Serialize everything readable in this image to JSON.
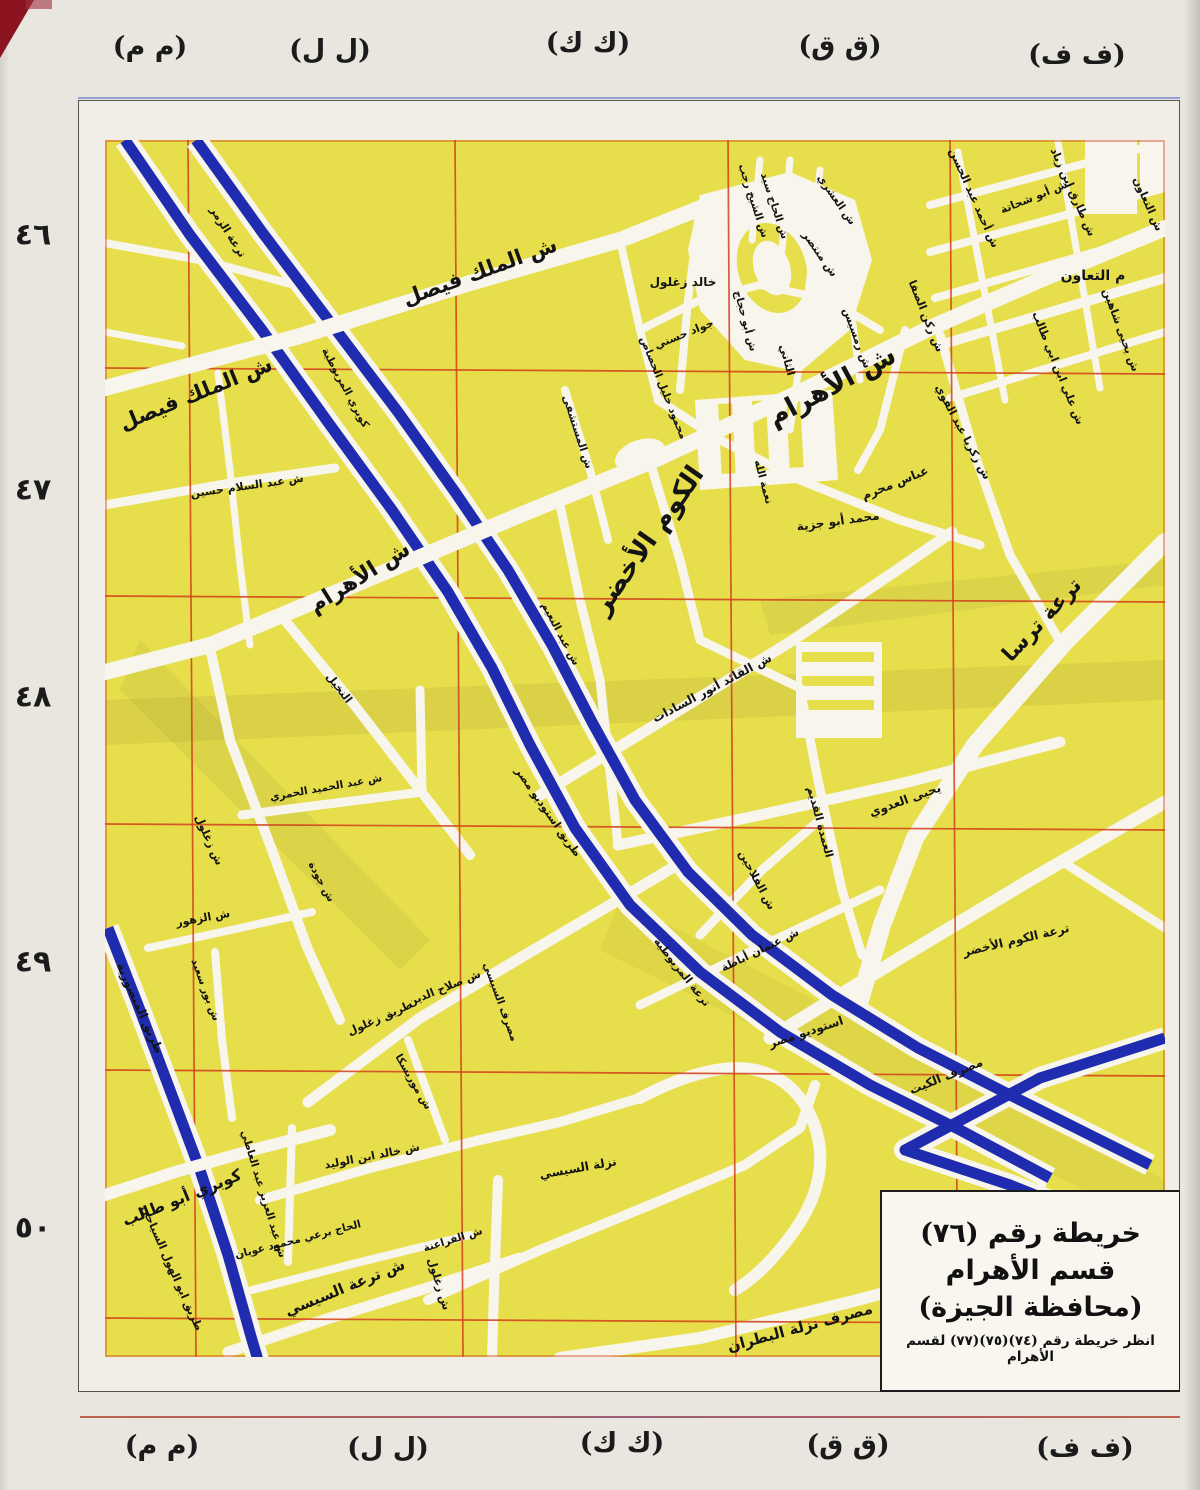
{
  "map_meta": {
    "title_line1": "خريطة رقم (٧٦)",
    "title_line2": "قسم الأهرام",
    "title_line3": "(محافظة الجيزة)",
    "title_line4": "انظر خريطة رقم (٧٤)(٧٥)(٧٧) لقسم الأهرام"
  },
  "colors": {
    "paper": "#e8e6de",
    "map_yellow": "#e7de4b",
    "road_white": "#f8f6ec",
    "canal_blue": "#1f2cb0",
    "grid_red": "#d2401c",
    "text_black": "#141414"
  },
  "margins": {
    "top": [
      {
        "text": "(م م)",
        "x": 150,
        "y": 47
      },
      {
        "text": "(ل ل)",
        "x": 330,
        "y": 50
      },
      {
        "text": "(ك ك)",
        "x": 588,
        "y": 43
      },
      {
        "text": "(ق ق)",
        "x": 840,
        "y": 46
      },
      {
        "text": "(ف ف)",
        "x": 1077,
        "y": 55
      }
    ],
    "bottom": [
      {
        "text": "(م م)",
        "x": 162,
        "y": 1446
      },
      {
        "text": "(ل ل)",
        "x": 388,
        "y": 1448
      },
      {
        "text": "(ك ك)",
        "x": 622,
        "y": 1443
      },
      {
        "text": "(ق ق)",
        "x": 848,
        "y": 1445
      },
      {
        "text": "(ف ف)",
        "x": 1085,
        "y": 1448
      }
    ],
    "left": [
      {
        "text": "٤٦",
        "x": 33,
        "y": 235
      },
      {
        "text": "٤٧",
        "x": 33,
        "y": 490
      },
      {
        "text": "٤٨",
        "x": 33,
        "y": 697
      },
      {
        "text": "٤٩",
        "x": 33,
        "y": 962
      },
      {
        "text": "٥٠",
        "x": 33,
        "y": 1228
      }
    ]
  },
  "map_labels": [
    {
      "text": "ش الملك فيصل",
      "x": 480,
      "y": 272,
      "rot": -20,
      "fs": 21
    },
    {
      "text": "ش الملك فيصل",
      "x": 196,
      "y": 394,
      "rot": -22,
      "fs": 21
    },
    {
      "text": "ش الأهرام",
      "x": 832,
      "y": 386,
      "rot": -28,
      "fs": 27
    },
    {
      "text": "ش الأهرام",
      "x": 360,
      "y": 578,
      "rot": -32,
      "fs": 22
    },
    {
      "text": "الكوم الأخضر",
      "x": 648,
      "y": 540,
      "rot": -55,
      "fs": 27
    },
    {
      "text": "ترعة ترسا",
      "x": 1042,
      "y": 620,
      "rot": -47,
      "fs": 21
    },
    {
      "text": "م التعاون",
      "x": 1093,
      "y": 276,
      "rot": 0,
      "fs": 14
    },
    {
      "text": "ش التعاون",
      "x": 1148,
      "y": 204,
      "rot": 66,
      "fs": 11
    },
    {
      "text": "ش أبو شحاتة",
      "x": 1034,
      "y": 197,
      "rot": -22,
      "fs": 11
    },
    {
      "text": "ش طارق ابن زياد",
      "x": 1073,
      "y": 192,
      "rot": 66,
      "fs": 11
    },
    {
      "text": "ش أحمد عبد الحسن",
      "x": 974,
      "y": 198,
      "rot": 66,
      "fs": 11
    },
    {
      "text": "ش يحيى شاهين",
      "x": 1121,
      "y": 330,
      "rot": 70,
      "fs": 11
    },
    {
      "text": "ش علي ابن ابي طالب",
      "x": 1058,
      "y": 368,
      "rot": 68,
      "fs": 11
    },
    {
      "text": "ش ركن الصفا",
      "x": 926,
      "y": 316,
      "rot": 68,
      "fs": 11
    },
    {
      "text": "ش زكريا عبد القوي",
      "x": 963,
      "y": 432,
      "rot": 62,
      "fs": 11
    },
    {
      "text": "خالد زغلول",
      "x": 683,
      "y": 282,
      "rot": 0,
      "fs": 12
    },
    {
      "text": "جواد حسني",
      "x": 684,
      "y": 334,
      "rot": -22,
      "fs": 11
    },
    {
      "text": "ش الشيخ رجب",
      "x": 753,
      "y": 201,
      "rot": 72,
      "fs": 10.5
    },
    {
      "text": "ش الحاج سيد",
      "x": 774,
      "y": 206,
      "rot": 72,
      "fs": 10.5
    },
    {
      "text": "ش منتصر",
      "x": 820,
      "y": 254,
      "rot": 55,
      "fs": 11
    },
    {
      "text": "ش العشري",
      "x": 836,
      "y": 200,
      "rot": 55,
      "fs": 10.5
    },
    {
      "text": "ش رمسيس",
      "x": 857,
      "y": 338,
      "rot": 70,
      "fs": 11
    },
    {
      "text": "الثاني",
      "x": 787,
      "y": 360,
      "rot": 75,
      "fs": 11
    },
    {
      "text": "ش أبو حجاج",
      "x": 745,
      "y": 321,
      "rot": 75,
      "fs": 10.5
    },
    {
      "text": "محمود خليل الحصاص",
      "x": 663,
      "y": 388,
      "rot": 68,
      "fs": 10.5
    },
    {
      "text": "نعمة الله",
      "x": 763,
      "y": 482,
      "rot": 75,
      "fs": 10.5
    },
    {
      "text": "عباس محرم",
      "x": 895,
      "y": 483,
      "rot": -22,
      "fs": 12
    },
    {
      "text": "محمد أبو جزية",
      "x": 838,
      "y": 521,
      "rot": -8,
      "fs": 12
    },
    {
      "text": "ش المستشفى",
      "x": 577,
      "y": 432,
      "rot": 72,
      "fs": 10.5
    },
    {
      "text": "ش عبد النعيم",
      "x": 560,
      "y": 634,
      "rot": 62,
      "fs": 10.5
    },
    {
      "text": "ش عبد السلام حسين",
      "x": 247,
      "y": 486,
      "rot": -8,
      "fs": 11
    },
    {
      "text": "ترعة الزمر",
      "x": 228,
      "y": 232,
      "rot": 58,
      "fs": 11
    },
    {
      "text": "كوبري المريوطية",
      "x": 345,
      "y": 388,
      "rot": 62,
      "fs": 10.5
    },
    {
      "text": "طريق استوديو مصر",
      "x": 548,
      "y": 812,
      "rot": 55,
      "fs": 11
    },
    {
      "text": "ترعة المريوطية",
      "x": 682,
      "y": 972,
      "rot": 52,
      "fs": 11
    },
    {
      "text": "ش القائد أنور السادات",
      "x": 712,
      "y": 688,
      "rot": -28,
      "fs": 12
    },
    {
      "text": "يحيى العدوي",
      "x": 905,
      "y": 800,
      "rot": -20,
      "fs": 12
    },
    {
      "text": "العمدة القديم",
      "x": 820,
      "y": 822,
      "rot": 75,
      "fs": 11
    },
    {
      "text": "ش الفلاحين",
      "x": 757,
      "y": 880,
      "rot": 62,
      "fs": 11
    },
    {
      "text": "ش عثمان أباظة",
      "x": 760,
      "y": 950,
      "rot": -26,
      "fs": 11
    },
    {
      "text": "ترعة الكوم الأخضر",
      "x": 1016,
      "y": 940,
      "rot": -13,
      "fs": 12
    },
    {
      "text": "استوديو مصر",
      "x": 806,
      "y": 1032,
      "rot": -18,
      "fs": 12
    },
    {
      "text": "مصرف الكيت",
      "x": 946,
      "y": 1076,
      "rot": -22,
      "fs": 12
    },
    {
      "text": "النخيل",
      "x": 339,
      "y": 688,
      "rot": 52,
      "fs": 11
    },
    {
      "text": "ش عبد الحميد الحمري",
      "x": 326,
      "y": 788,
      "rot": -10,
      "fs": 10.5
    },
    {
      "text": "ش زغلول",
      "x": 209,
      "y": 840,
      "rot": 66,
      "fs": 11
    },
    {
      "text": "ش جودة",
      "x": 321,
      "y": 882,
      "rot": 62,
      "fs": 10.5
    },
    {
      "text": "ش الزهور",
      "x": 203,
      "y": 918,
      "rot": -10,
      "fs": 11
    },
    {
      "text": "ش بور سعيد",
      "x": 205,
      "y": 990,
      "rot": 70,
      "fs": 10.5
    },
    {
      "text": "طريق المنصورية",
      "x": 140,
      "y": 1008,
      "rot": 66,
      "fs": 12
    },
    {
      "text": "طريق ابو الهول السياحي",
      "x": 172,
      "y": 1268,
      "rot": 66,
      "fs": 11
    },
    {
      "text": "كوبري أبو طالب",
      "x": 182,
      "y": 1198,
      "rot": -22,
      "fs": 16
    },
    {
      "text": "مصرف السيسي",
      "x": 500,
      "y": 1002,
      "rot": 70,
      "fs": 10.5
    },
    {
      "text": "ش صلاح الدين",
      "x": 444,
      "y": 988,
      "rot": -22,
      "fs": 11
    },
    {
      "text": "طريق زغلول",
      "x": 380,
      "y": 1018,
      "rot": -24,
      "fs": 11
    },
    {
      "text": "ش موريسكا",
      "x": 413,
      "y": 1082,
      "rot": 60,
      "fs": 10.5
    },
    {
      "text": "ش خالد ابن الوليد",
      "x": 372,
      "y": 1156,
      "rot": -11,
      "fs": 11
    },
    {
      "text": "نزلة السيسي",
      "x": 578,
      "y": 1168,
      "rot": -10,
      "fs": 12
    },
    {
      "text": "ش عبد العزيز عبد العاطي",
      "x": 263,
      "y": 1194,
      "rot": 73,
      "fs": 10.5
    },
    {
      "text": "الحاج برعي محمود عويان",
      "x": 298,
      "y": 1240,
      "rot": -14,
      "fs": 10.5
    },
    {
      "text": "ش ترعة السيسي",
      "x": 345,
      "y": 1288,
      "rot": -22,
      "fs": 15
    },
    {
      "text": "ش زغلول",
      "x": 439,
      "y": 1284,
      "rot": 73,
      "fs": 11
    },
    {
      "text": "ش الفراعنة",
      "x": 453,
      "y": 1240,
      "rot": -17,
      "fs": 10.5
    },
    {
      "text": "مصرف نزلة البطران",
      "x": 800,
      "y": 1328,
      "rot": -15,
      "fs": 15
    }
  ]
}
